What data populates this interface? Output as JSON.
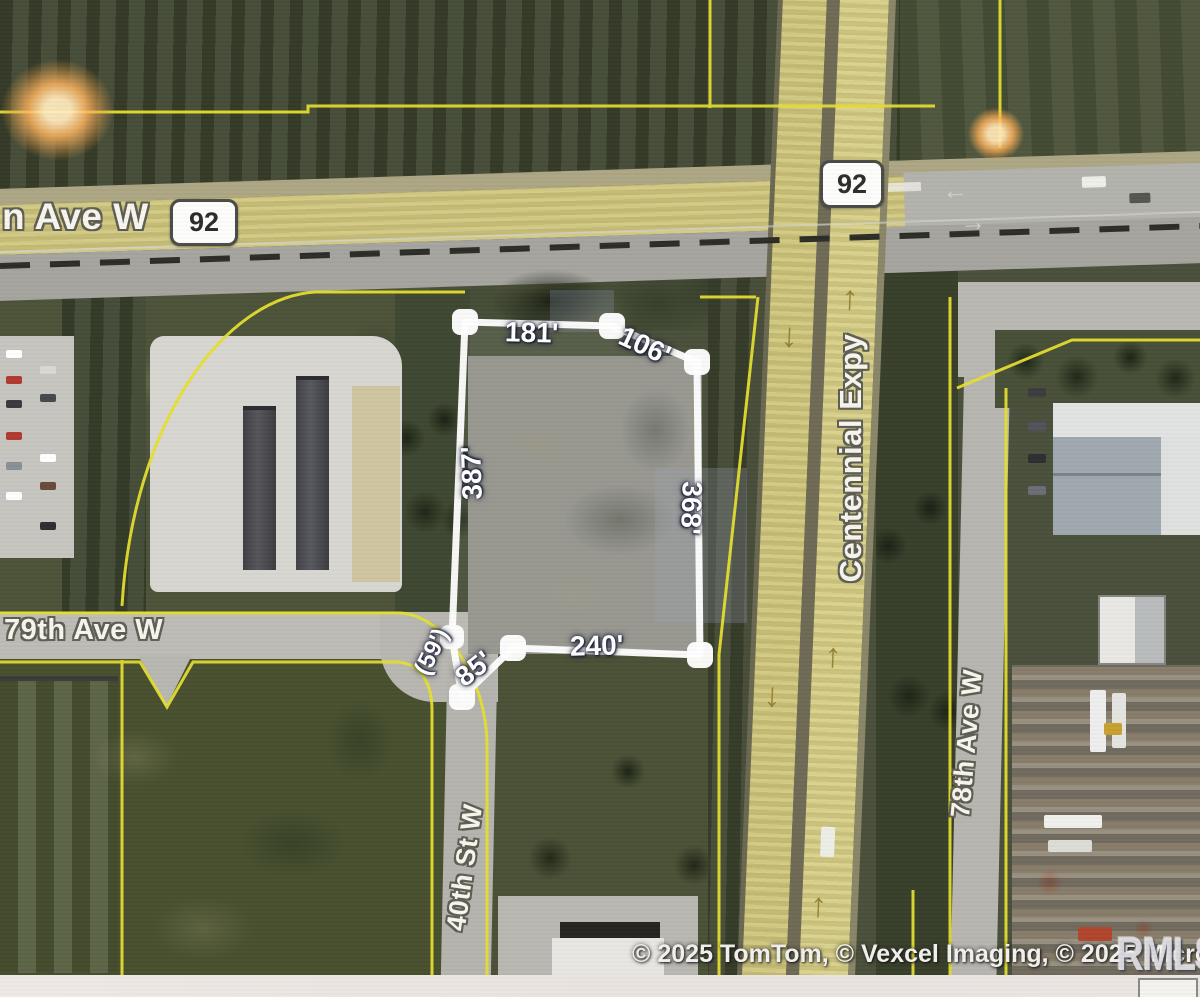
{
  "roads": {
    "ave_w_label": "n Ave W",
    "route_badge_left": "92",
    "route_badge_right": "92",
    "ave_79_label": "79th Ave W",
    "centennial_label": "Centennial Expy",
    "st_40_label": "40th St W",
    "ave_78_label": "78th Ave W"
  },
  "parcel": {
    "dim_top": "181'",
    "dim_top_right": "106'",
    "dim_left": "387'",
    "dim_right": "368'",
    "dim_bottom": "240'",
    "dim_sw_diagonal": "85'",
    "dim_sw_small": "(59')"
  },
  "markings": {
    "arrow_up": "↑",
    "arrow_down": "↓",
    "arrow_left": "←",
    "arrow_right": "→"
  },
  "footer": {
    "attribution": "© 2025 TomTom, © Vexcel Imaging, © 2025 Microsoft Corpor",
    "watermark": "RMLSA"
  },
  "colors": {
    "boundary_yellow": "#e6e02e",
    "parcel_outline": "#ffffff",
    "dimension_text": "#ffffff",
    "route_badge_bg": "#fdfdfb",
    "route_badge_border": "#4a4a46",
    "highlighted_road": "#cfc67c",
    "field_olive": "#49503a"
  }
}
